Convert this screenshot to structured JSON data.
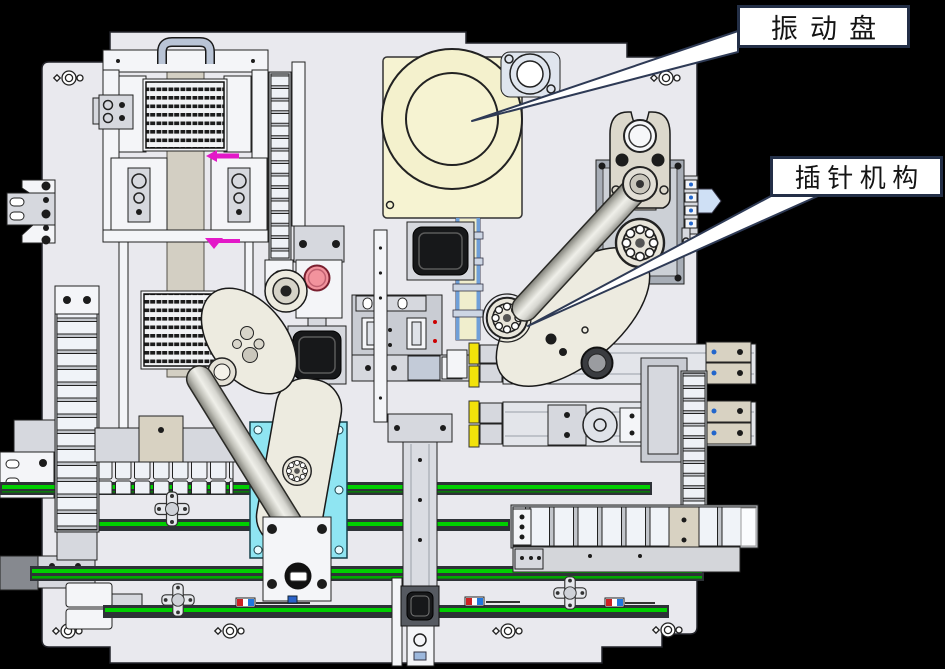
{
  "figure": {
    "type": "cad-top-view-diagram",
    "description": "Top view CAD layout of an automated pin-insertion machine"
  },
  "callouts": {
    "vibratory_bowl": {
      "label": "振动盘"
    },
    "pin_mechanism": {
      "label": "插针机构"
    }
  },
  "colors": {
    "background": "#000000",
    "base_plate": "#e9e9ee",
    "bowl_plate_yellow": "#f6f3d2",
    "conveyor_green": "#00cf00",
    "robot_mount_cyan": "#8fe5f2",
    "marker_magenta": "#e318c8",
    "estop_pink": "#f2939d",
    "stopper_yellow": "#f2e20a",
    "callout_border": "#232f47",
    "leader_fill": "#ffffff"
  }
}
